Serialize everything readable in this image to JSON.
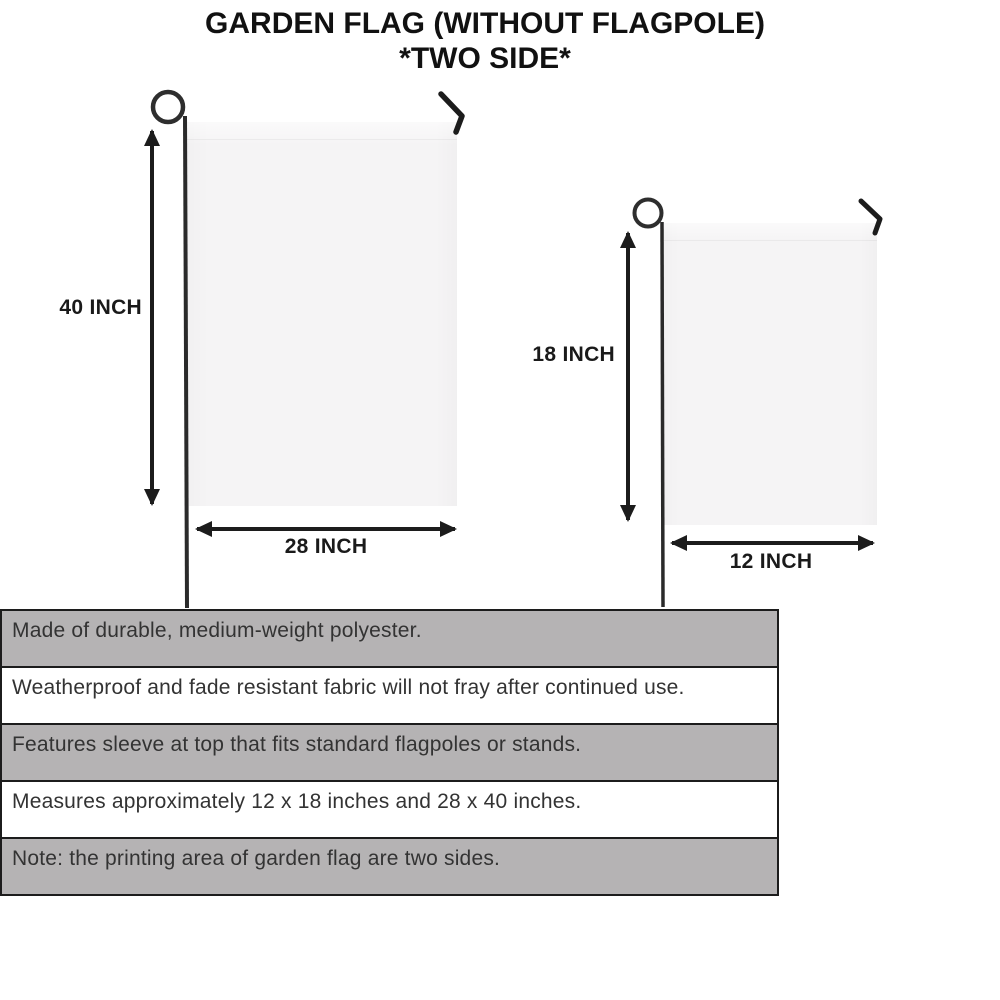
{
  "title": {
    "line1": "GARDEN FLAG (WITHOUT FLAGPOLE)",
    "line2": "*TWO SIDE*"
  },
  "diagrams": {
    "large": {
      "height_label": "40 INCH",
      "width_label": "28 INCH"
    },
    "small": {
      "height_label": "18 INCH",
      "width_label": "12 INCH"
    }
  },
  "features": [
    "Made of durable, medium-weight polyester.",
    "Weatherproof and fade resistant fabric will not fray after continued use.",
    "Features sleeve at top that fits standard flagpoles or stands.",
    "Measures approximately 12 x 18 inches and 28 x 40 inches.",
    "Note: the printing area of garden flag are two sides."
  ],
  "colors": {
    "row-gray": "#b5b3b4",
    "row-white": "#ffffff",
    "row-border": "#1c1c1c",
    "text-dark": "#111111",
    "feature-text": "#333333",
    "flag-fill": "#f5f4f5",
    "metal": "#2a2a2a"
  }
}
